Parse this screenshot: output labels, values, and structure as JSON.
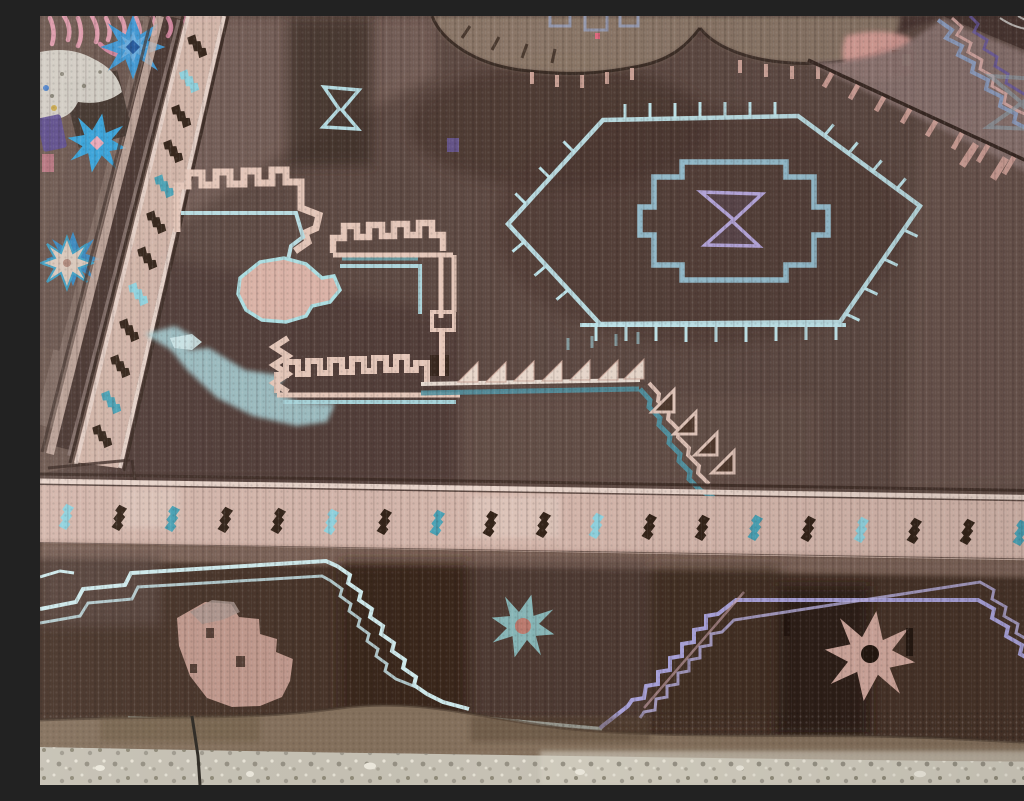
{
  "scene": {
    "title": "Antique handmade tribal rug on a concrete floor",
    "description": "Close-up oblique photograph of a worn antique Anatolian village rug in brown, plum and mauve tones decorated with light-blue, teal, lavender and pale-pink geometric motifs: blue eight-pointed stars, a tick-edged hexagonal medallion with stepped cross and lavender hourglass, pink crenellated castle motifs, sawtooth triangles, diagonal slash borders, and a lower border of stepped medallions with stars. A speckled concrete floor with a thin dark cord shows along the bottom edge; pink fringe and a white fleece peek in at the top-left corner.",
    "subject_type": "photograph, no text content"
  },
  "rug": {
    "palette": {
      "field_base": "#5f4b44",
      "field_dark": "#47342e",
      "field_deep": "#372823",
      "field_light": "#7a645c",
      "tan_medallion": "#8e7a6b",
      "mauve_band": "#8d7672",
      "border_band_pink": "#d8baae",
      "guard_dark": "#3e2d26",
      "slash_dark": "#342419",
      "slash_teal": "#4aa2b5",
      "slash_blue": "#8fd2de",
      "motif_pink": "#e6c8ba",
      "motif_blue": "#b9dde2",
      "hexagon_blue": "#bfe4ea",
      "cross_blue": "#9ccadd",
      "lavender": "#b6a7dc",
      "star_blue": "#3f97d3",
      "star_pink_center": "#eaa9b8",
      "bottom_border": "#483429",
      "trapezoid_blue": "#cfeaec",
      "polygon_pink": "#c79e91",
      "teal_star": "#8abcbe",
      "pink_star": "#d1a89d",
      "selvedge": "#84705c"
    },
    "motifs": [
      {
        "name": "blue-eight-point-stars",
        "count": 3,
        "area": "top-left edge"
      },
      {
        "name": "diagonal-slash-guard-border",
        "slashes": 12,
        "area": "upper-left, running diagonally"
      },
      {
        "name": "horizontal-slash-guard-border",
        "slashes": 19,
        "area": "full width, lower middle"
      },
      {
        "name": "hexagon-medallion-with-ticks",
        "area": "upper center-right",
        "contains": [
          "stepped-cross",
          "lavender-hourglass"
        ]
      },
      {
        "name": "blue-hourglass-outline",
        "area": "upper left of field"
      },
      {
        "name": "crenellated-castle-motifs",
        "count": 3,
        "area": "left center field"
      },
      {
        "name": "sawtooth-triangle-row",
        "triangles": 11,
        "area": "center, stepping down to the right"
      },
      {
        "name": "tan-partial-medallion",
        "area": "top center, cut by frame"
      },
      {
        "name": "mauve-diagonal-band-with-pink-ticks",
        "area": "top right corner"
      },
      {
        "name": "zigzag-corner-lines",
        "area": "extreme top right"
      },
      {
        "name": "stepped-trapezoid-medallion",
        "outline": "light blue",
        "area": "bottom left border"
      },
      {
        "name": "stepped-hexagon-medallion",
        "outline": "lavender",
        "area": "bottom right border"
      },
      {
        "name": "pink-stepped-polygon",
        "area": "inside bottom-left trapezoid"
      },
      {
        "name": "teal-star",
        "area": "bottom border center-left"
      },
      {
        "name": "pink-star",
        "area": "bottom border right"
      },
      {
        "name": "partial-blue-star",
        "area": "bottom border, right edge"
      },
      {
        "name": "pink-fringe-and-fleece",
        "area": "top-left corner"
      },
      {
        "name": "light-blue-ragged-patch",
        "area": "mid-left field"
      }
    ]
  },
  "floor": {
    "material": "speckled concrete / terrazzo",
    "color": "#c6c1b4",
    "visible": "strip along bottom edge",
    "extras": [
      "worn rug selvedge above floor",
      "thin dark cord crossing floor lower-left"
    ]
  }
}
